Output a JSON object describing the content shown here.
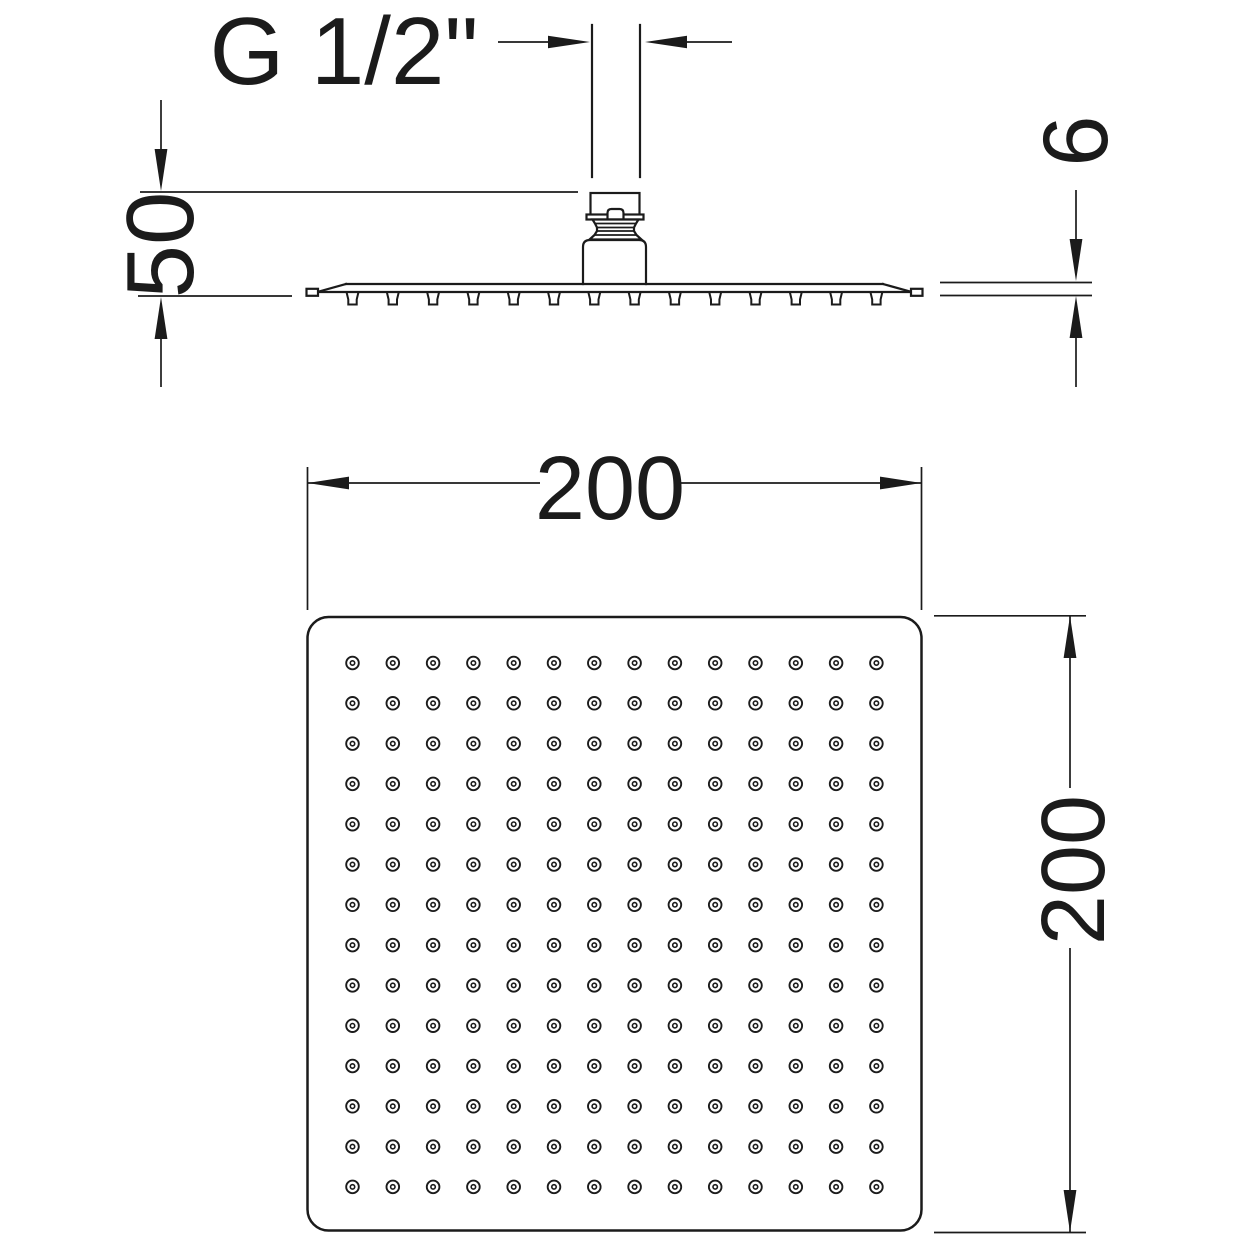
{
  "drawing": {
    "background": "#ffffff",
    "line_color": "#1b1b1b",
    "side_view": {
      "connection_label": "G 1/2\"",
      "drop_height_mm": "50",
      "thickness_mm": "6"
    },
    "face_view": {
      "width_mm": "200",
      "height_mm": "200",
      "nozzle_rows": 14,
      "nozzle_cols": 14
    }
  }
}
